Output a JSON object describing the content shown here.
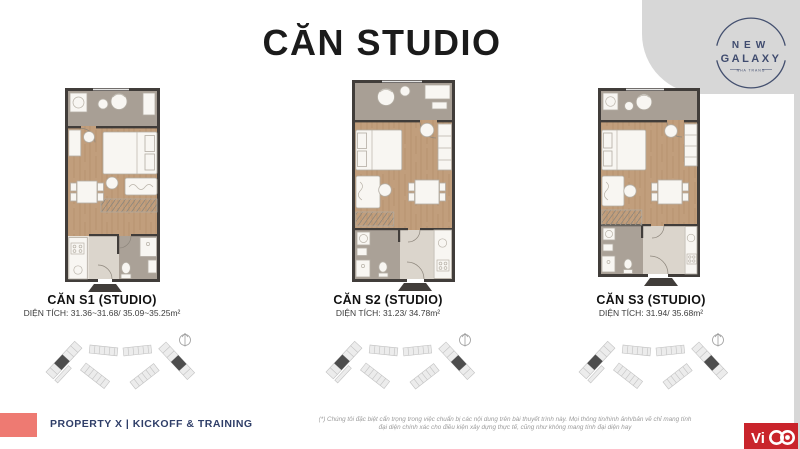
{
  "header": {
    "title": "CĂN STUDIO"
  },
  "logo": {
    "line1": "NEW",
    "line2": "GALAXY",
    "tagline": "NHA TRANG"
  },
  "plans": [
    {
      "name": "CĂN S1 (STUDIO)",
      "area": "DIỆN TÍCH: 31.36~31.68/ 35.09~35.25m²"
    },
    {
      "name": "CĂN S2 (STUDIO)",
      "area": "DIỆN TÍCH: 31.23/ 34.78m²"
    },
    {
      "name": "CĂN S3 (STUDIO)",
      "area": "DIỆN TÍCH: 31.94/ 35.68m²"
    }
  ],
  "footer": {
    "event": "PROPERTY X | KICKOFF & TRAINING",
    "disclaimer_line1": "(*) Chúng tôi đặc biệt cẩn trọng trong việc chuẩn bị các nội dung trên bài thuyết trình này. Mọi thông tin/hình ảnh/bản vẽ chỉ mang tính",
    "disclaimer_line2": "đại diện chính xác cho điều kiện xây dựng thực tế, cũng như không mang tính đại diện hay",
    "vico_text": "Vi"
  },
  "colors": {
    "accent_red": "#c9242b",
    "accent_salmon": "#ee7a72",
    "navy": "#2f3e68",
    "wall": "#413d3a",
    "wood": "#c19e7c",
    "tile_gray": "#a89f95"
  }
}
